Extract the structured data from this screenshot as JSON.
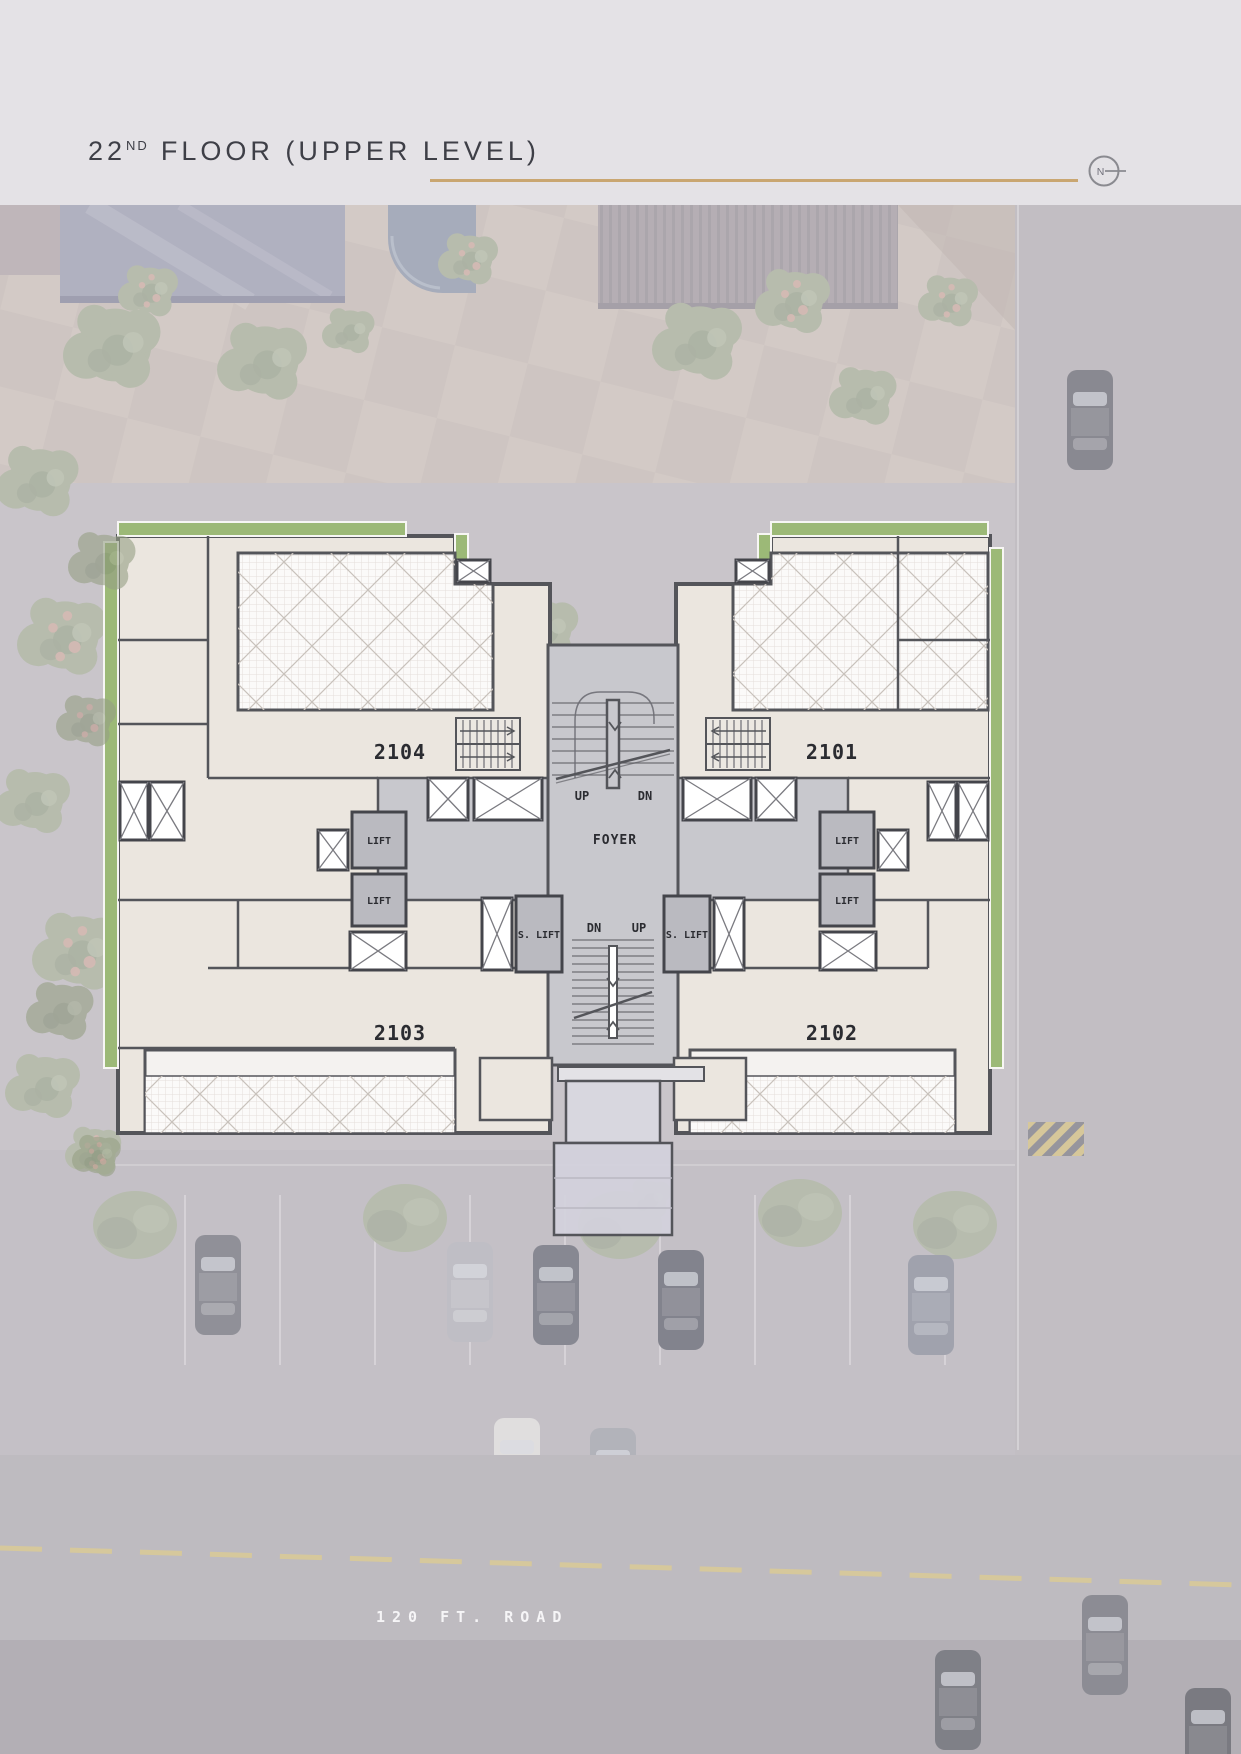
{
  "header": {
    "floor_number": "22",
    "floor_ordinal": "ND",
    "floor_title": "FLOOR (UPPER LEVEL)",
    "compass_letter": "N"
  },
  "plan": {
    "units": [
      "2104",
      "2101",
      "2103",
      "2102"
    ],
    "labels": {
      "foyer": "FOYER",
      "up": "UP",
      "dn": "DN",
      "lift": "LIFT",
      "service_lift": "S. LIFT"
    }
  },
  "road": {
    "label": "120 FT. ROAD"
  },
  "colors": {
    "accent_gold": "#C9A671",
    "landscape_green": "#9CB977",
    "wall": "#54555A",
    "room_cream": "#EBE6DF",
    "corridor_gray": "#C8C8CD",
    "terrace_white": "#FBFAF9",
    "header_band": "#E4E2E6"
  }
}
